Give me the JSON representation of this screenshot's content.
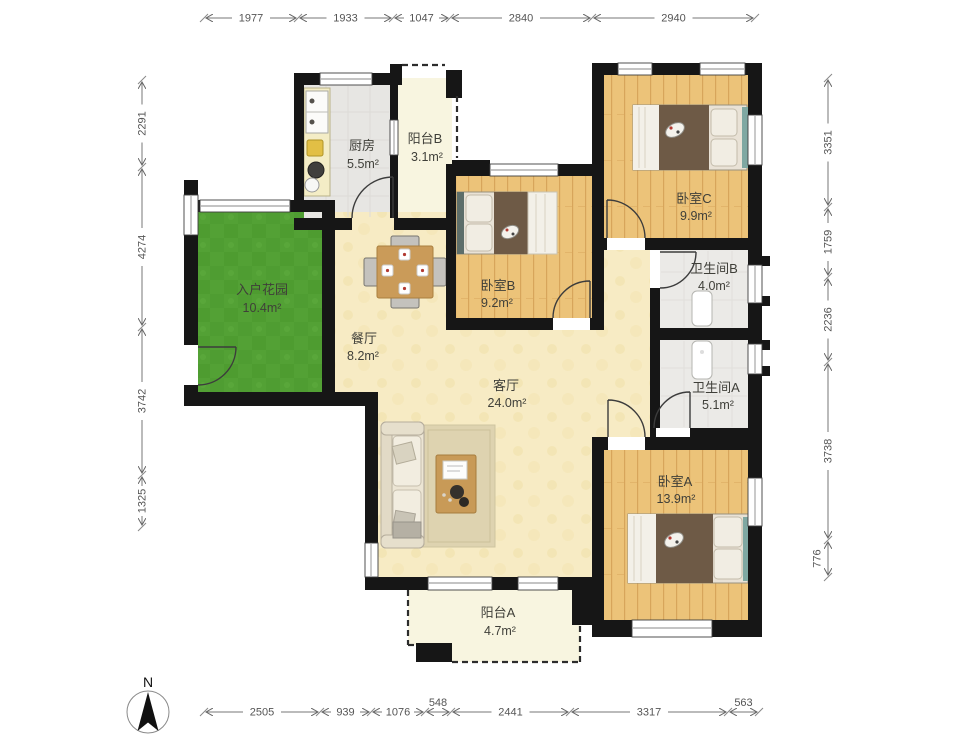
{
  "watermark": "lianjia",
  "compass": {
    "label": "N"
  },
  "rooms": [
    {
      "id": "entry-garden",
      "name": "入户花园",
      "area": "10.4m²"
    },
    {
      "id": "kitchen",
      "name": "厨房",
      "area": "5.5m²"
    },
    {
      "id": "balcony-b",
      "name": "阳台B",
      "area": "3.1m²"
    },
    {
      "id": "bedroom-b",
      "name": "卧室B",
      "area": "9.2m²"
    },
    {
      "id": "bedroom-c",
      "name": "卧室C",
      "area": "9.9m²"
    },
    {
      "id": "bathroom-b",
      "name": "卫生间B",
      "area": "4.0m²"
    },
    {
      "id": "bathroom-a",
      "name": "卫生间A",
      "area": "5.1m²"
    },
    {
      "id": "dining-room",
      "name": "餐厅",
      "area": "8.2m²"
    },
    {
      "id": "living-room",
      "name": "客厅",
      "area": "24.0m²"
    },
    {
      "id": "bedroom-a",
      "name": "卧室A",
      "area": "13.9m²"
    },
    {
      "id": "balcony-a",
      "name": "阳台A",
      "area": "4.7m²"
    }
  ],
  "dimensions": {
    "top": [
      "1977",
      "1933",
      "1047",
      "2840",
      "2940"
    ],
    "bottom": [
      "2505",
      "939",
      "1076",
      "548",
      "2441",
      "3317",
      "563"
    ],
    "left": [
      "2291",
      "4274",
      "3742",
      "1325"
    ],
    "right": [
      "3351",
      "1759",
      "2236",
      "3738",
      "776"
    ]
  },
  "colors": {
    "wall": "#161616",
    "wood-base": "#ecc379",
    "wood-line": "#d7a55b",
    "living-floor": "#f7ebc4",
    "living-tex": "#efdfa6",
    "kitchen-floor": "#e7e6e3",
    "bath-floor": "#ebeae7",
    "balcony-floor": "#f8f5e0",
    "garden-base": "#53a135",
    "garden-dark": "#47962b",
    "teal": "#7fa8a2",
    "bed-dark": "#6e5a46",
    "door-stroke": "#3c3c3c",
    "dim-color": "#777",
    "label-color": "#3f3f39"
  }
}
